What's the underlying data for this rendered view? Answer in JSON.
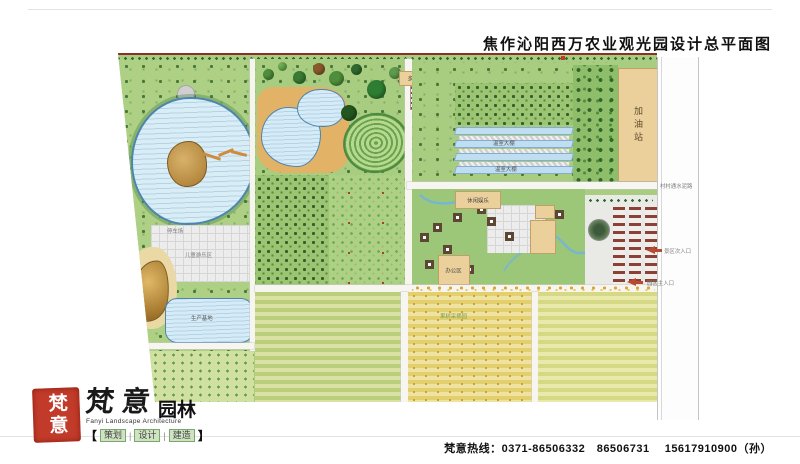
{
  "header": {
    "title": "焦作沁阳西万农业观光园设计总平面图"
  },
  "plan": {
    "labels": {
      "multi_greenhouse": "多功能温室大棚",
      "eco_parking": "生态停车",
      "greenhouse_a": "温室大棚",
      "greenhouse_b": "温室大棚",
      "gas_station": "加油站",
      "leisure": "休闲娱乐",
      "office": "办公区",
      "parking_lot": "停车场",
      "kids_area": "儿童游乐区",
      "production_base": "生产基地",
      "orchard_picking": "果树采摘园",
      "entry_secondary": "景区次入口",
      "entry_main": "园区主入口",
      "road_note": "村村通水泥路"
    }
  },
  "footer": {
    "seal_text": "梵意",
    "brand_script": "梵意",
    "brand_suffix": "园林",
    "brand_en": "Fanyi Landscape Architecture",
    "bracket_left": "【",
    "bracket_right": "】",
    "divider": "|",
    "services": [
      "策划",
      "设计",
      "建造"
    ],
    "hotline": "梵意热线：0371-86506332　86506731　 15617910900（孙）"
  }
}
